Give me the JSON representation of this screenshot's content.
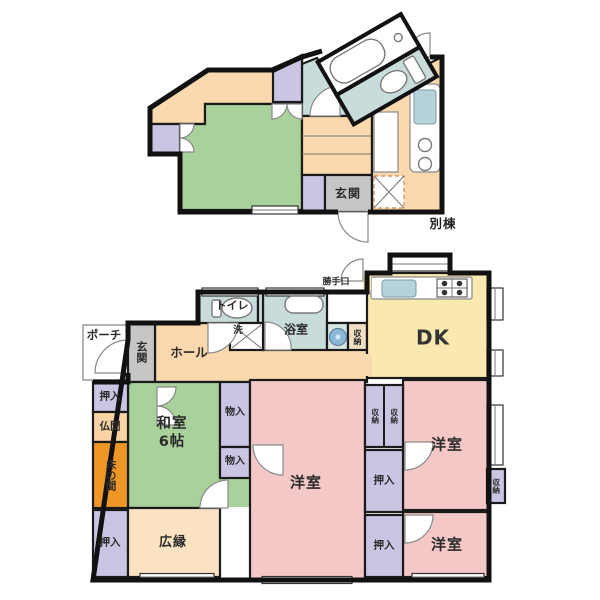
{
  "plan_title": "間取り図",
  "annex": {
    "name_label": "別棟",
    "genkan": "玄関"
  },
  "rooms": {
    "porch": "ポーチ",
    "genkan": "玄関",
    "hall": "ホール",
    "toilet": "トイレ",
    "wash": "洗",
    "bath": "浴室",
    "storage": "収納",
    "back_door": "勝手口",
    "dk": "DK",
    "washitsu": "和室\n6帖",
    "butsuma": "仏間",
    "tokonoma": "床の間",
    "oshiire": "押入",
    "monoire": "物入",
    "western": "洋室",
    "hiroen": "広縁"
  },
  "palette": {
    "wall": "#111111",
    "tatami_green": "#a9d19b",
    "western_pink": "#f4c8c6",
    "dk_yellow": "#f9e8b0",
    "closet_lavender": "#cbc4e3",
    "wet_teal": "#c8dcdc",
    "hall_peach": "#fbd9ae",
    "veranda_cream": "#fbe2c3",
    "tokonoma_orange": "#ef9726",
    "butsuma_orange": "#fbd3a4",
    "genkan_gray": "#c6c6c6",
    "basin_blue": "#8bb8d9",
    "sink_teal": "#b7d3da"
  }
}
